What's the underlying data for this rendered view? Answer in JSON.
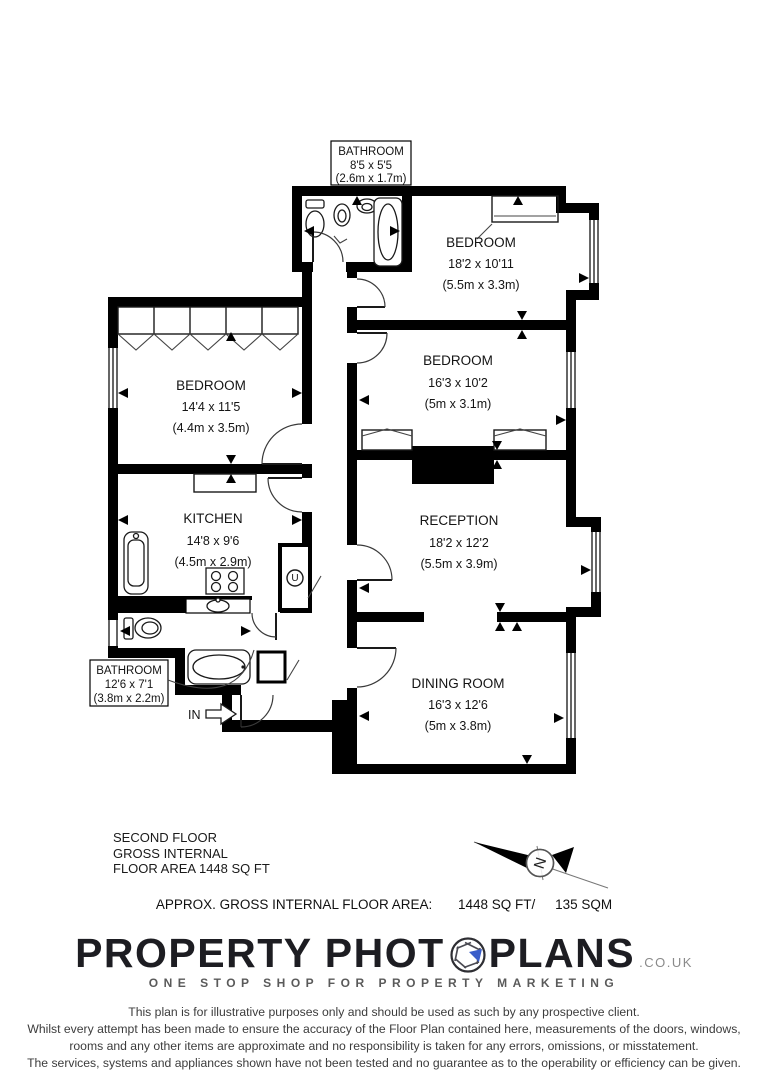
{
  "plan": {
    "rooms": [
      {
        "id": "bathroom-top",
        "name": "BATHROOM",
        "imperial": "8'5 x 5'5",
        "metric": "(2.6m x 1.7m)"
      },
      {
        "id": "bedroom-top-right",
        "name": "BEDROOM",
        "imperial": "18'2 x 10'11",
        "metric": "(5.5m x 3.3m)"
      },
      {
        "id": "bedroom-mid-right",
        "name": "BEDROOM",
        "imperial": "16'3 x 10'2",
        "metric": "(5m x 3.1m)"
      },
      {
        "id": "bedroom-left",
        "name": "BEDROOM",
        "imperial": "14'4 x 11'5",
        "metric": "(4.4m x 3.5m)"
      },
      {
        "id": "kitchen",
        "name": "KITCHEN",
        "imperial": "14'8 x 9'6",
        "metric": "(4.5m x 2.9m)"
      },
      {
        "id": "reception",
        "name": "RECEPTION",
        "imperial": "18'2 x 12'2",
        "metric": "(5.5m x 3.9m)"
      },
      {
        "id": "dining-room",
        "name": "DINING ROOM",
        "imperial": "16'3 x 12'6",
        "metric": "(5m x 3.8m)"
      },
      {
        "id": "bathroom-lower",
        "name": "BATHROOM",
        "imperial": "12'6 x 7'1",
        "metric": "(3.8m x 2.2m)"
      }
    ],
    "entrance_label": "IN",
    "utility_label": "U"
  },
  "footer": {
    "floor_title_lines": [
      "SECOND FLOOR",
      "GROSS INTERNAL",
      "FLOOR AREA 1448 SQ FT"
    ],
    "area_label": "APPROX. GROSS INTERNAL FLOOR AREA:",
    "area_imperial": "1448 SQ FT/",
    "area_metric": "135 SQM",
    "compass_letter": "N"
  },
  "branding": {
    "logo_part1": "PROPERTY PHOT",
    "logo_part2": "PLANS",
    "logo_suffix": ".CO.UK",
    "tagline": "ONE STOP SHOP FOR PROPERTY MARKETING",
    "accent_color": "#3a5dc9"
  },
  "disclaimer": {
    "lines": [
      "This plan is for illustrative purposes only and should be used as such by any prospective client.",
      "Whilst every attempt has been made to ensure the accuracy of the Floor Plan contained here, measurements of the doors, windows,",
      "rooms and any other items are approximate and no responsibility is taken for any errors, omissions, or misstatement.",
      "The services, systems and appliances shown have not been tested and no guarantee as to the operability or efficiency can be given."
    ]
  }
}
